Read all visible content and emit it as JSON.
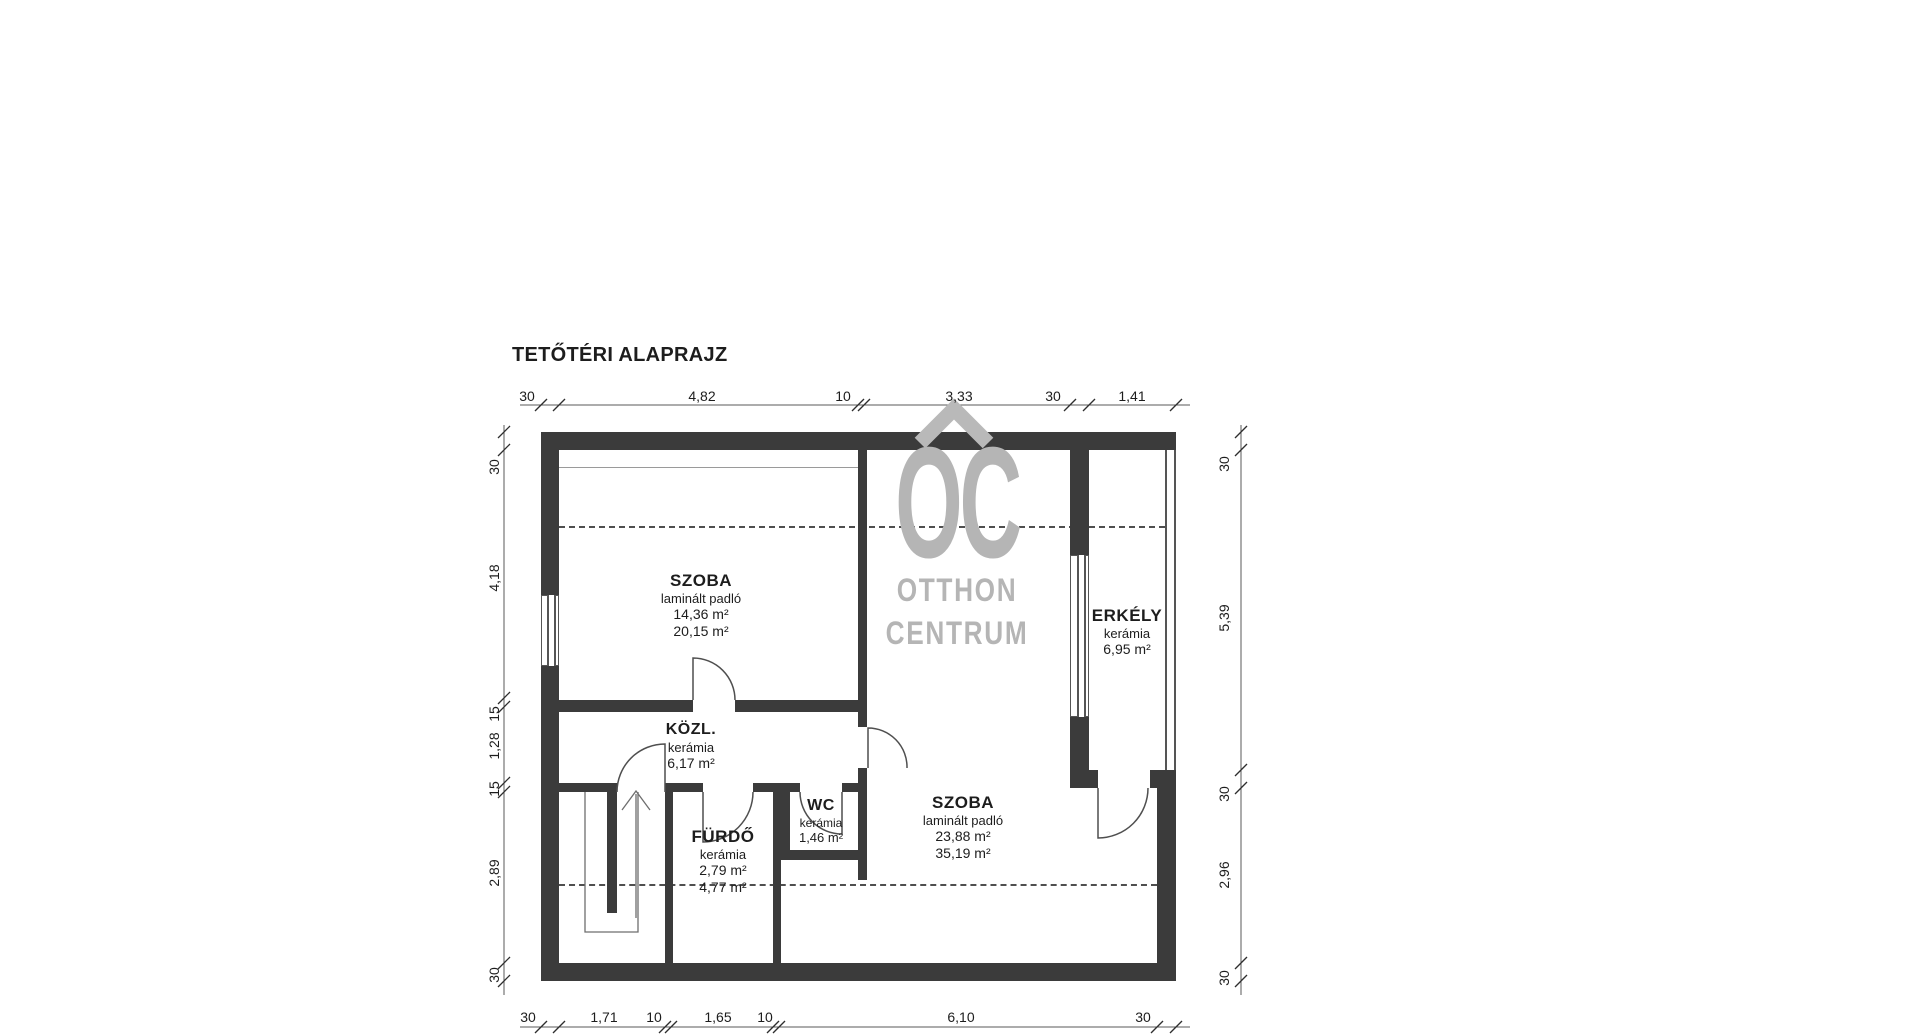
{
  "title": "TETŐTÉRI ALAPRAJZ",
  "watermark": {
    "roof_icon": "house-roof-chevron",
    "logo": "OC",
    "name_line1": "OTTHON",
    "name_line2": "CENTRUM",
    "color": "#b5b5b5"
  },
  "rooms": {
    "szoba1": {
      "name": "SZOBA",
      "floor": "laminált padló",
      "area_net": "14,36 m²",
      "area_gross": "20,15 m²"
    },
    "kozl": {
      "name": "KÖZL.",
      "floor": "kerámia",
      "area_net": "6,17 m²"
    },
    "furdo": {
      "name": "FÜRDŐ",
      "floor": "kerámia",
      "area_net": "2,79 m²",
      "area_gross": "4,77 m²"
    },
    "wc": {
      "name": "WC",
      "floor": "kerámia",
      "area_net": "1,46 m²"
    },
    "szoba2": {
      "name": "SZOBA",
      "floor": "laminált padló",
      "area_net": "23,88 m²",
      "area_gross": "35,19 m²"
    },
    "erkely": {
      "name": "ERKÉLY",
      "floor": "kerámia",
      "area_net": "6,95 m²"
    }
  },
  "dimensions": {
    "top": [
      "30",
      "4,82",
      "10",
      "3,33",
      "30",
      "1,41"
    ],
    "bottom": [
      "30",
      "1,71",
      "10",
      "1,65",
      "10",
      "6,10",
      "30"
    ],
    "left": [
      "30",
      "4,18",
      "15",
      "1,28",
      "15",
      "2,89",
      "30"
    ],
    "right": [
      "30",
      "5,39",
      "30",
      "2,96",
      "30"
    ]
  },
  "colors": {
    "wall": "#3b3b3b",
    "line": "#555555",
    "text": "#1d1d1d"
  }
}
